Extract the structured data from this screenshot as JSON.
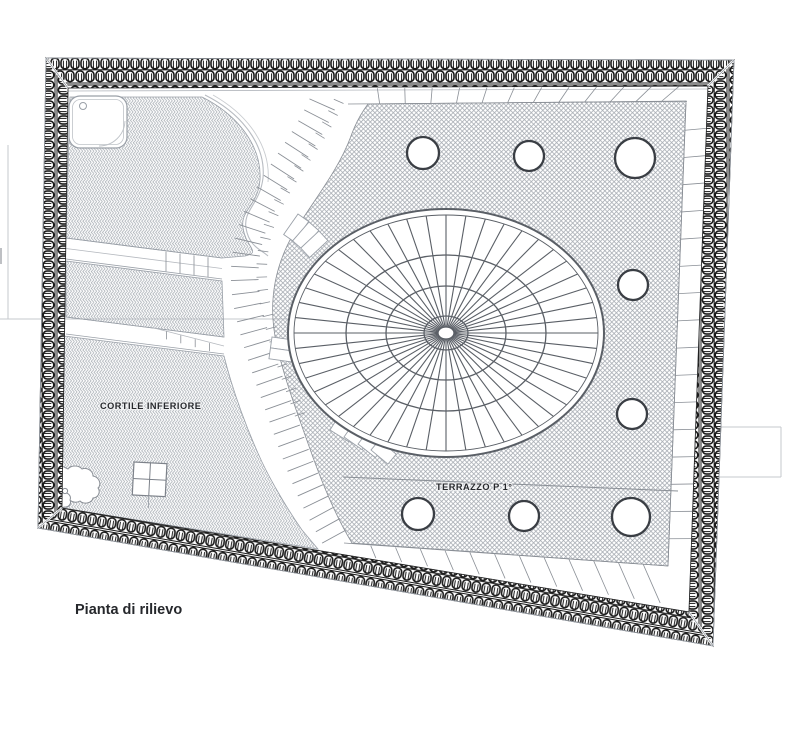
{
  "drawing": {
    "caption": "Pianta di rilievo",
    "areas": {
      "courtyard_label": "CORTILE INFERIORE",
      "terrace_label": "TERRAZZO P 1°"
    },
    "colors": {
      "chain_dark": "#1a1a1a",
      "outline_main": "#7d828a",
      "pattern_gray": "#a6abb2",
      "faint_gray": "#c6c9ce",
      "text": "#26282c",
      "tick_gray": "#8a8f96",
      "rosette_gray": "#5a5f66",
      "circle_stroke": "#3a3e44"
    },
    "geometry": {
      "rosette": {
        "cx": 446,
        "cy": 333,
        "rx": 158,
        "ry": 124,
        "spokes": 48,
        "rings": [
          [
            152,
            118
          ],
          [
            100,
            78
          ],
          [
            60,
            47
          ],
          [
            22,
            17
          ],
          [
            8,
            6
          ]
        ]
      },
      "circles": [
        [
          423,
          153,
          16
        ],
        [
          529,
          156,
          15
        ],
        [
          635,
          158,
          20
        ],
        [
          633,
          285,
          15
        ],
        [
          632,
          414,
          15
        ],
        [
          418,
          514,
          16
        ],
        [
          524,
          516,
          15
        ],
        [
          631,
          517,
          19
        ]
      ]
    }
  }
}
